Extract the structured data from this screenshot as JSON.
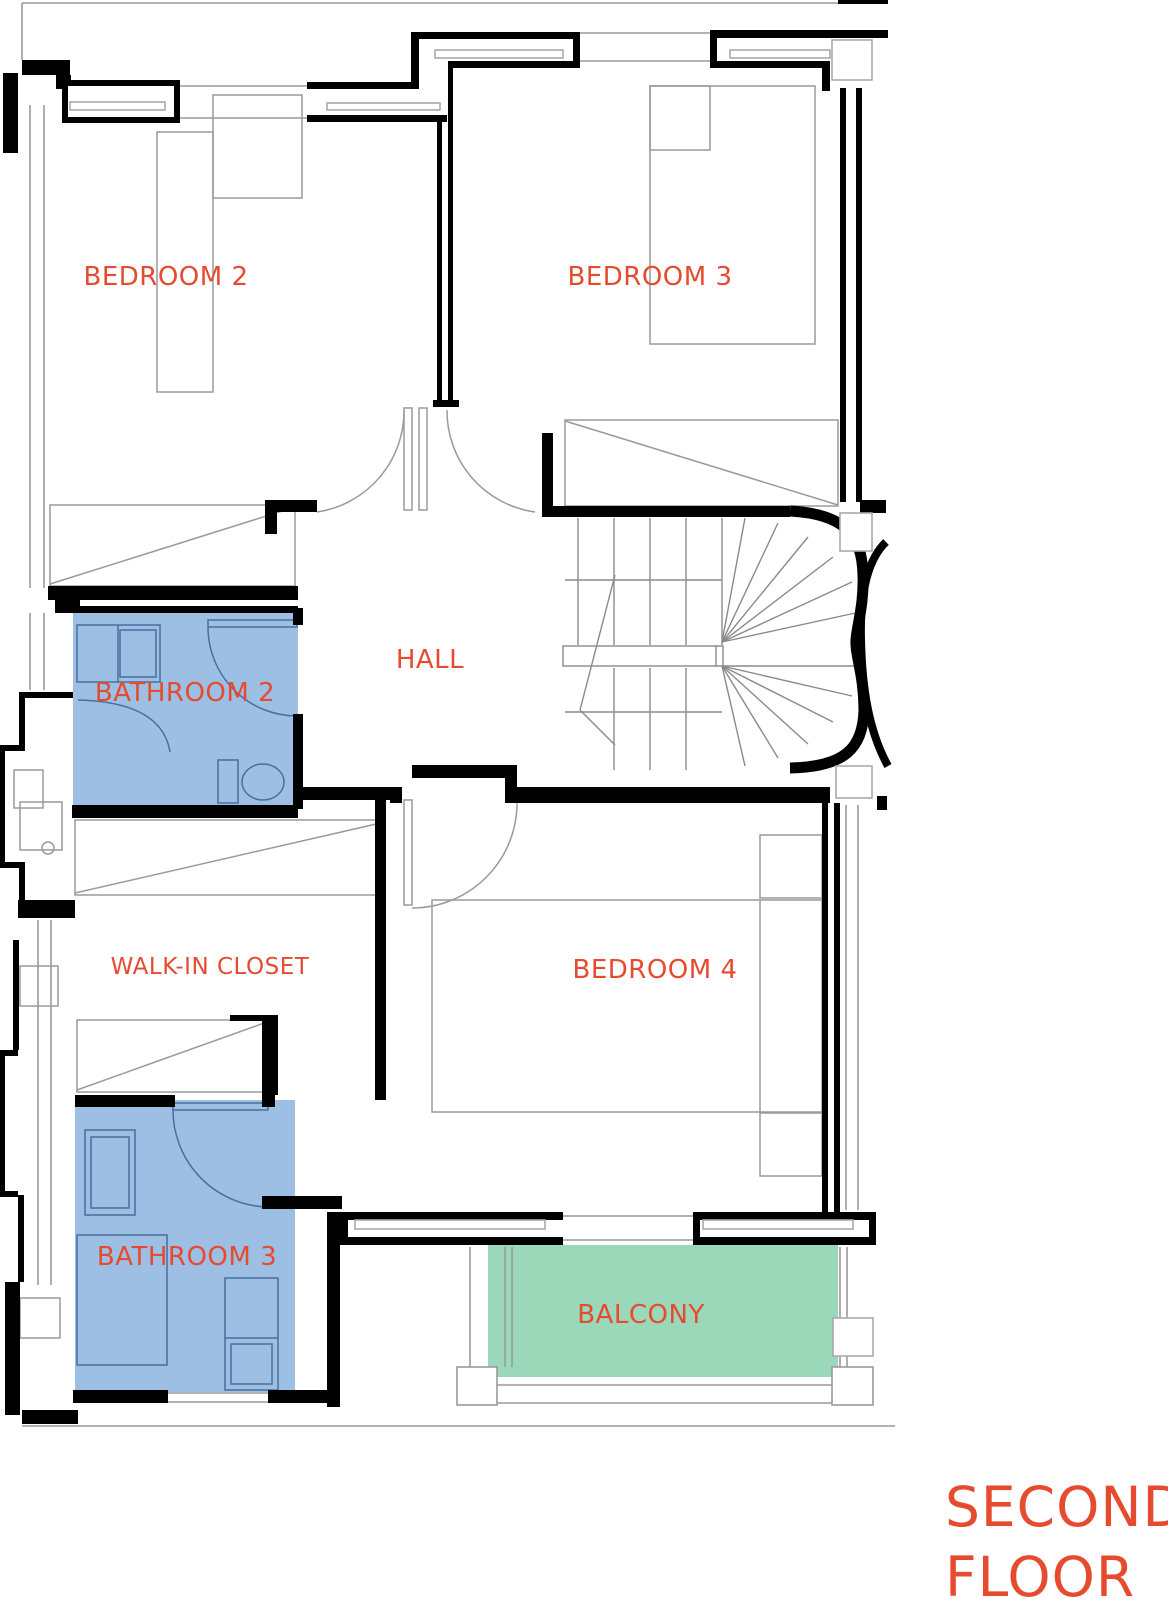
{
  "title": {
    "line1": "SECOND",
    "line2": "FLOOR"
  },
  "rooms": {
    "bedroom2": {
      "label": "BEDROOM 2"
    },
    "bedroom3": {
      "label": "BEDROOM 3"
    },
    "hall": {
      "label": "HALL"
    },
    "bathroom2": {
      "label": "BATHROOM 2"
    },
    "walk_in_closet": {
      "label": "WALK-IN CLOSET"
    },
    "bedroom4": {
      "label": "BEDROOM 4"
    },
    "bathroom3": {
      "label": "BATHROOM 3"
    },
    "balcony": {
      "label": "BALCONY"
    }
  },
  "colors": {
    "label_text": "#E64B2F",
    "title_text": "#E64B2F",
    "bathroom_fill": "#9DBFE3",
    "bathroom_line": "#4A6F9F",
    "balcony_fill": "#9BD8BA",
    "wall": "#000000",
    "thin_line": "#999999"
  }
}
